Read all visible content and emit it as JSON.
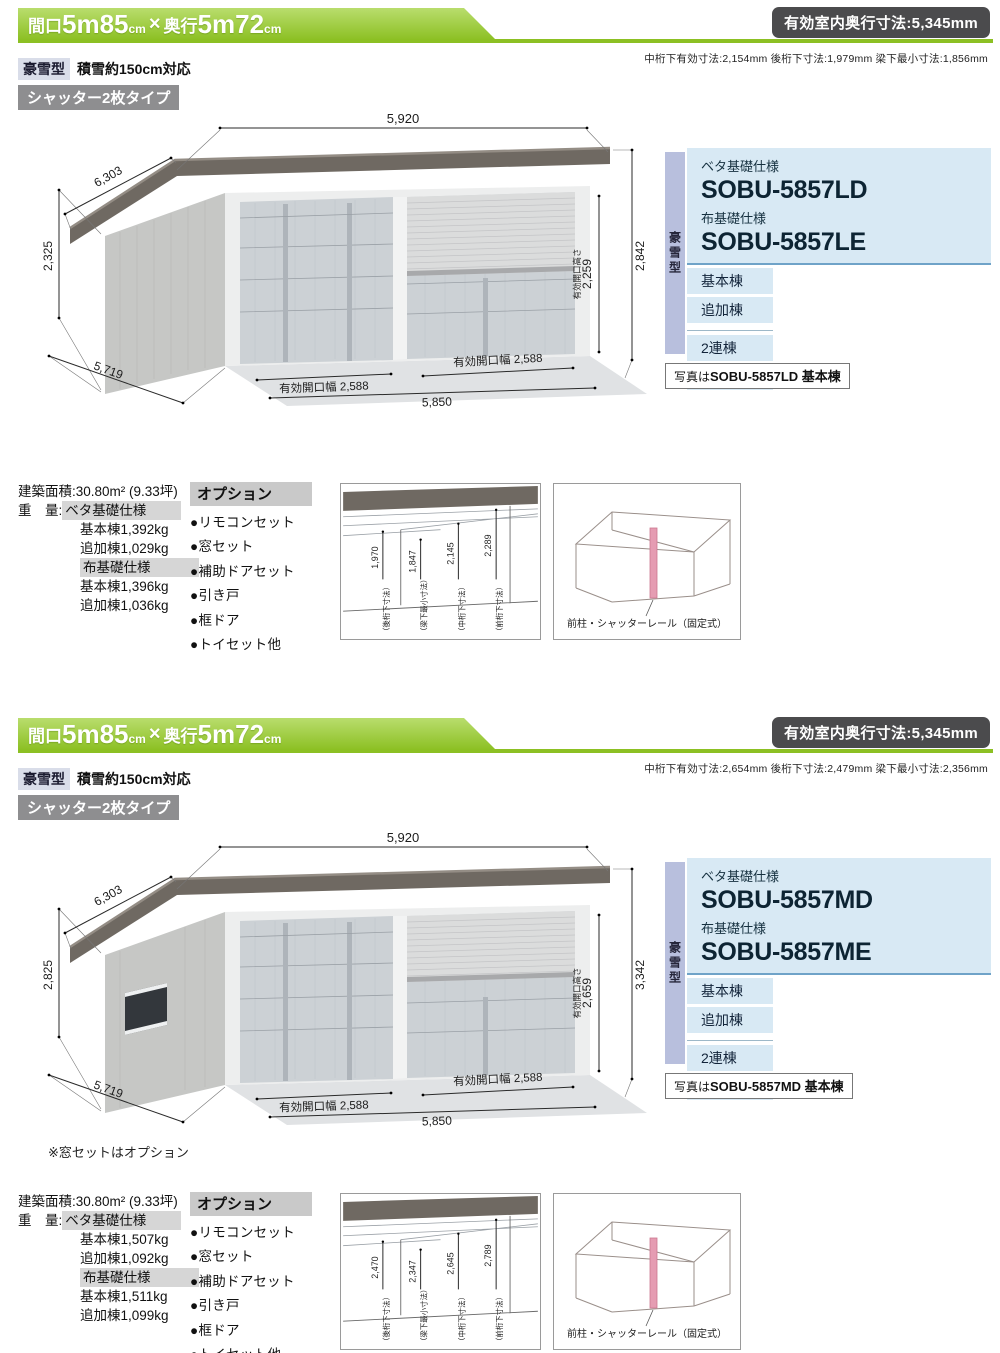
{
  "colors": {
    "banner_green": "#8cc023",
    "badge_dark": "#4b4b4d",
    "panel_blue": "#d8e9f4",
    "panel_tab_lavender": "#b8bfdd",
    "panel_rule_blue": "#6fa3c8",
    "shutter_badge_gray": "#8e8e90",
    "roof_gray": "#6f6962",
    "pillar_pink": "#e59cb2"
  },
  "sections": [
    {
      "banner": {
        "maguchi_label": "間口",
        "maguchi_num": "5m85",
        "cm_a": "cm",
        "times": "×",
        "okuyuki_label": "奥行",
        "okuyuki_num": "5m72",
        "cm_b": "cm"
      },
      "depth_badge": "有効室内奥行寸法:5,345mm",
      "sub_note": "中桁下有効寸法:2,154mm 後桁下寸法:1,979mm 梁下最小寸法:1,856mm",
      "type_badge": "豪雪型",
      "type_note": "積雪約150cm対応",
      "shutter_badge": "シャッター2枚タイプ",
      "drawing": {
        "dim_width_top": "5,920",
        "dim_depth_top": "6,303",
        "dim_height_left": "2,325",
        "dim_depth_bottom": "5,719",
        "dim_height_right": "2,842",
        "opening_height_label": "有効開口高さ",
        "opening_height": "2,259",
        "opening_width_left": "有効開口幅 2,588",
        "opening_width_right": "有効開口幅 2,588",
        "dim_width_bottom": "5,850"
      },
      "panel": {
        "tab": "豪雪型",
        "beta_label": "ベタ基礎仕様",
        "beta_model": "SOBU-5857LD",
        "nuno_label": "布基礎仕様",
        "nuno_model": "SOBU-5857LE",
        "item_1": "基本棟",
        "item_2": "追加棟",
        "item_3": "2連棟",
        "item_4": "3連棟",
        "photo_prefix": "写真は",
        "photo_model": "SOBU-5857LD 基本棟"
      },
      "info": {
        "area_label": "建築面積:",
        "area_value": "30.80m² (9.33坪)",
        "weight_label": "重　量:",
        "beta_header": "ベタ基礎仕様",
        "beta_row_1": "基本棟1,392kg",
        "beta_row_2": "追加棟1,029kg",
        "nuno_header": "布基礎仕様",
        "nuno_row_1": "基本棟1,396kg",
        "nuno_row_2": "追加棟1,036kg"
      },
      "options": {
        "title": "オプション",
        "item_1": "●リモコンセット",
        "item_2": "●窓セット",
        "item_3": "●補助ドアセット",
        "item_4": "●引き戸",
        "item_5": "●框ドア",
        "item_6": "●トイセット他"
      },
      "cross_section": {
        "dim_1": "1,970",
        "label_1": "（後桁下寸法）",
        "dim_2": "1,847",
        "label_2": "（梁下最小寸法）",
        "dim_3": "2,145",
        "label_3": "（中桁下寸法）",
        "dim_4": "2,289",
        "label_4": "（前桁下寸法）"
      },
      "pillar_box": {
        "label": "前柱・シャッターレール（固定式）"
      }
    },
    {
      "banner": {
        "maguchi_label": "間口",
        "maguchi_num": "5m85",
        "cm_a": "cm",
        "times": "×",
        "okuyuki_label": "奥行",
        "okuyuki_num": "5m72",
        "cm_b": "cm"
      },
      "depth_badge": "有効室内奥行寸法:5,345mm",
      "sub_note": "中桁下有効寸法:2,654mm 後桁下寸法:2,479mm 梁下最小寸法:2,356mm",
      "type_badge": "豪雪型",
      "type_note": "積雪約150cm対応",
      "shutter_badge": "シャッター2枚タイプ",
      "drawing": {
        "dim_width_top": "5,920",
        "dim_depth_top": "6,303",
        "dim_height_left": "2,825",
        "dim_depth_bottom": "5,719",
        "dim_height_right": "3,342",
        "opening_height_label": "有効開口高さ",
        "opening_height": "2,659",
        "opening_width_left": "有効開口幅 2,588",
        "opening_width_right": "有効開口幅 2,588",
        "dim_width_bottom": "5,850",
        "window_note": "※窓セットはオプション"
      },
      "panel": {
        "tab": "豪雪型",
        "beta_label": "ベタ基礎仕様",
        "beta_model": "SOBU-5857MD",
        "nuno_label": "布基礎仕様",
        "nuno_model": "SOBU-5857ME",
        "item_1": "基本棟",
        "item_2": "追加棟",
        "item_3": "2連棟",
        "item_4": "3連棟",
        "photo_prefix": "写真は",
        "photo_model": "SOBU-5857MD 基本棟"
      },
      "info": {
        "area_label": "建築面積:",
        "area_value": "30.80m² (9.33坪)",
        "weight_label": "重　量:",
        "beta_header": "ベタ基礎仕様",
        "beta_row_1": "基本棟1,507kg",
        "beta_row_2": "追加棟1,092kg",
        "nuno_header": "布基礎仕様",
        "nuno_row_1": "基本棟1,511kg",
        "nuno_row_2": "追加棟1,099kg"
      },
      "options": {
        "title": "オプション",
        "item_1": "●リモコンセット",
        "item_2": "●窓セット",
        "item_3": "●補助ドアセット",
        "item_4": "●引き戸",
        "item_5": "●框ドア",
        "item_6": "●トイセット他"
      },
      "cross_section": {
        "dim_1": "2,470",
        "label_1": "（後桁下寸法）",
        "dim_2": "2,347",
        "label_2": "（梁下最小寸法）",
        "dim_3": "2,645",
        "label_3": "（中桁下寸法）",
        "dim_4": "2,789",
        "label_4": "（前桁下寸法）"
      },
      "pillar_box": {
        "label": "前柱・シャッターレール（固定式）"
      }
    }
  ]
}
